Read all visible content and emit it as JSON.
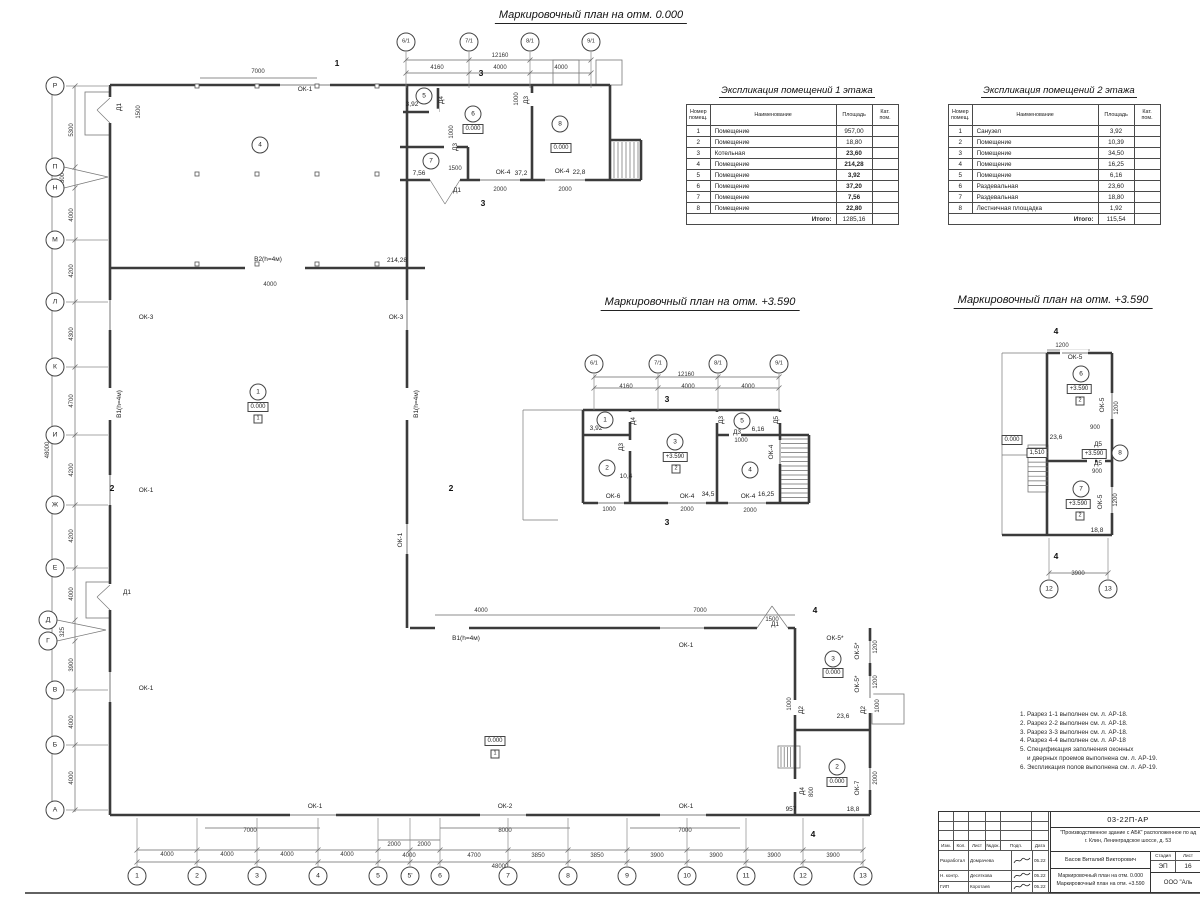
{
  "plans": {
    "main": {
      "title": "Маркировочный план на отм. 0.000",
      "x": 591,
      "y": 17
    },
    "mezz": {
      "title": "Маркировочный план на отм. +3.590",
      "x": 700,
      "y": 304
    },
    "right": {
      "title": "Маркировочный план на отм. +3.590",
      "x": 1053,
      "y": 302
    }
  },
  "tables": {
    "floor1": {
      "title": "Экспликация помещений 1 этажа",
      "headers": [
        "Номер помещ.",
        "Наименование",
        "Площадь",
        "Кат. пом."
      ],
      "rows": [
        [
          "1",
          "Помещение",
          "957,00"
        ],
        [
          "2",
          "Помещение",
          "18,80"
        ],
        [
          "3",
          "Котельная",
          "23,60"
        ],
        [
          "4",
          "Помещение",
          "214,28"
        ],
        [
          "5",
          "Помещение",
          "3,92"
        ],
        [
          "6",
          "Помещение",
          "37,20"
        ],
        [
          "7",
          "Помещение",
          "7,56"
        ],
        [
          "8",
          "Помещение",
          "22,80"
        ]
      ],
      "total_label": "Итого:",
      "total": "1285,16"
    },
    "floor2": {
      "title": "Экспликация помещений 2 этажа",
      "headers": [
        "Номер помещ.",
        "Наименование",
        "Площадь",
        "Кат. пом."
      ],
      "rows": [
        [
          "1",
          "Санузел",
          "3,92"
        ],
        [
          "2",
          "Помещение",
          "10,39"
        ],
        [
          "3",
          "Помещение",
          "34,50"
        ],
        [
          "4",
          "Помещение",
          "16,25"
        ],
        [
          "5",
          "Помещение",
          "6,16"
        ],
        [
          "6",
          "Раздевальная",
          "23,60"
        ],
        [
          "7",
          "Раздевальная",
          "18,80"
        ],
        [
          "8",
          "Лестничная площадка",
          "1,92"
        ]
      ],
      "total_label": "Итого:",
      "total": "115,54"
    }
  },
  "notes": [
    "1. Разрез 1-1 выполнен см. л. АР-18.",
    "2. Разрез 2-2 выполнен см. л. АР-18.",
    "3. Разрез 3-3 выполнен см. л. АР-18.",
    "4. Разрез 4-4 выполнен см. л. АР-18",
    "5. Спецификация заполнения оконных\n    и дверных проемов выполнена см. л. АР-19.",
    "6. Экспликация полов выполнена см. л. АР-19."
  ],
  "title_block": {
    "doc_code": "03-22П-АР",
    "project_line1": "\"Производственное здание с АБК\" расположенное по ад",
    "project_line2": "г. Клин, Ленинградское шоссе, д. 53",
    "columns": [
      "Изм.",
      "Кол.",
      "Лист",
      "№док.",
      "Подп.",
      "Дата"
    ],
    "rows": [
      {
        "role": "Разработал",
        "name": "Домрачева",
        "date": "05.22"
      },
      {
        "role": "Н. контр.",
        "name": "Десяткова",
        "date": "05.22"
      },
      {
        "role": "ГИП",
        "name": "Коротаев",
        "date": "05.22"
      }
    ],
    "author": "Басов Виталий Викторович",
    "stage_label": "Стадия",
    "sheet_label": "Лист",
    "stage": "ЭП",
    "sheet_no": "16",
    "doc_title1": "Маркировочный план на отм. 0.000",
    "doc_title2": "Маркировочный план на отм. +3.590",
    "company": "ООО \"Аль"
  },
  "axes": {
    "left": [
      [
        "Р",
        55,
        86
      ],
      [
        "П",
        55,
        167
      ],
      [
        "Н",
        55,
        188
      ],
      [
        "М",
        55,
        240
      ],
      [
        "Л",
        55,
        302
      ],
      [
        "К",
        55,
        367
      ],
      [
        "И",
        55,
        435
      ],
      [
        "Ж",
        55,
        505
      ],
      [
        "Е",
        55,
        568
      ],
      [
        "Д",
        48,
        620
      ],
      [
        "Г",
        48,
        641
      ],
      [
        "В",
        55,
        690
      ],
      [
        "Б",
        55,
        745
      ],
      [
        "А",
        55,
        810
      ]
    ],
    "bottom": [
      [
        "1",
        137,
        876
      ],
      [
        "2",
        197,
        876
      ],
      [
        "3",
        257,
        876
      ],
      [
        "4",
        318,
        876
      ],
      [
        "5",
        378,
        876
      ],
      [
        "5'",
        410,
        876
      ],
      [
        "6",
        440,
        876
      ],
      [
        "7",
        508,
        876
      ],
      [
        "8",
        568,
        876
      ],
      [
        "9",
        627,
        876
      ],
      [
        "10",
        687,
        876
      ],
      [
        "11",
        746,
        876
      ],
      [
        "12",
        803,
        876
      ],
      [
        "13",
        863,
        876
      ]
    ],
    "top_main": [
      [
        "6/1",
        406,
        42
      ],
      [
        "7/1",
        469,
        42
      ],
      [
        "8/1",
        530,
        42
      ],
      [
        "9/1",
        591,
        42
      ]
    ],
    "mezz": [
      [
        "6/1",
        594,
        364
      ],
      [
        "7/1",
        658,
        364
      ],
      [
        "8/1",
        718,
        364
      ],
      [
        "9/1",
        779,
        364
      ]
    ],
    "right_bottom": [
      [
        "12",
        1049,
        589
      ],
      [
        "13",
        1108,
        589
      ]
    ]
  },
  "rooms": {
    "main": [
      [
        "4",
        260,
        145
      ],
      [
        "5",
        424,
        96
      ],
      [
        "6",
        473,
        114
      ],
      [
        "7",
        431,
        161
      ],
      [
        "8",
        560,
        124
      ],
      [
        "1",
        258,
        392
      ],
      [
        "3",
        833,
        659
      ],
      [
        "2",
        837,
        767
      ]
    ],
    "mezz": [
      [
        "1",
        605,
        420
      ],
      [
        "2",
        607,
        468
      ],
      [
        "3",
        675,
        442
      ],
      [
        "5",
        742,
        421
      ],
      [
        "4",
        750,
        470
      ]
    ],
    "right": [
      [
        "6",
        1081,
        374
      ],
      [
        "7",
        1081,
        489
      ],
      [
        "8",
        1120,
        453
      ]
    ]
  },
  "labels": [
    [
      "ОК-1",
      305,
      90,
      "l"
    ],
    [
      "3,92",
      412,
      105,
      "l"
    ],
    [
      "7,56",
      419,
      174,
      "l"
    ],
    [
      "ОК-4",
      503,
      173,
      "l"
    ],
    [
      "37,2",
      521,
      174,
      "l"
    ],
    [
      "ОК-4",
      562,
      172,
      "l"
    ],
    [
      "22,8",
      579,
      173,
      "l"
    ],
    [
      "Д1",
      457,
      191,
      "l"
    ],
    [
      "В2(h=4м)",
      268,
      260,
      "l"
    ],
    [
      "214,28",
      397,
      261,
      "l"
    ],
    [
      "ОК-3",
      146,
      318,
      "l"
    ],
    [
      "ОК-3",
      396,
      318,
      "l"
    ],
    [
      "ОК-1",
      146,
      491,
      "l"
    ],
    [
      "ОК-1",
      146,
      689,
      "l"
    ],
    [
      "Д1",
      127,
      593,
      "l"
    ],
    [
      "В1(h=4м)",
      466,
      639,
      "l"
    ],
    [
      "ОК-1",
      686,
      646,
      "l"
    ],
    [
      "Д1",
      775,
      625,
      "l"
    ],
    [
      "ОК-5*",
      835,
      639,
      "l"
    ],
    [
      "23,6",
      843,
      717,
      "l"
    ],
    [
      "957",
      791,
      810,
      "l"
    ],
    [
      "18,8",
      853,
      810,
      "l"
    ],
    [
      "ОК-1",
      315,
      807,
      "l"
    ],
    [
      "ОК-2",
      505,
      807,
      "l"
    ],
    [
      "ОК-1",
      686,
      807,
      "l"
    ],
    [
      "Д1",
      120,
      107,
      "lr"
    ],
    [
      "Д4",
      442,
      100,
      "lr"
    ],
    [
      "Д3",
      527,
      100,
      "lr"
    ],
    [
      "Д3",
      456,
      147,
      "lr"
    ],
    [
      "В1(h=4м)",
      120,
      404,
      "lr"
    ],
    [
      "В1(h=4м)",
      417,
      404,
      "lr"
    ],
    [
      "ОК-1",
      401,
      540,
      "lr"
    ],
    [
      "ОК-5*",
      858,
      651,
      "lr"
    ],
    [
      "ОК-5*",
      858,
      684,
      "lr"
    ],
    [
      "Д2",
      802,
      710,
      "lr"
    ],
    [
      "Д2",
      864,
      710,
      "lr"
    ],
    [
      "ОК-7",
      858,
      788,
      "lr"
    ],
    [
      "Д4",
      803,
      791,
      "lr"
    ],
    [
      "7000",
      258,
      72,
      "d"
    ],
    [
      "12160",
      500,
      56,
      "d"
    ],
    [
      "4160",
      437,
      68,
      "d"
    ],
    [
      "4000",
      500,
      68,
      "d"
    ],
    [
      "4000",
      561,
      68,
      "d"
    ],
    [
      "1000",
      452,
      132,
      "dr"
    ],
    [
      "1500",
      455,
      169,
      "d"
    ],
    [
      "2000",
      500,
      190,
      "d"
    ],
    [
      "2000",
      565,
      190,
      "d"
    ],
    [
      "1000",
      517,
      99,
      "dr"
    ],
    [
      "1500",
      139,
      112,
      "dr"
    ],
    [
      "4000",
      270,
      285,
      "d"
    ],
    [
      "4000",
      481,
      611,
      "d"
    ],
    [
      "7000",
      700,
      611,
      "d"
    ],
    [
      "1500",
      772,
      620,
      "d"
    ],
    [
      "5300",
      72,
      130,
      "dr"
    ],
    [
      "300",
      63,
      178,
      "dr"
    ],
    [
      "4000",
      72,
      215,
      "dr"
    ],
    [
      "4200",
      72,
      271,
      "dr"
    ],
    [
      "4300",
      72,
      334,
      "dr"
    ],
    [
      "4700",
      72,
      401,
      "dr"
    ],
    [
      "4200",
      72,
      470,
      "dr"
    ],
    [
      "4200",
      72,
      536,
      "dr"
    ],
    [
      "4000",
      72,
      594,
      "dr"
    ],
    [
      "325",
      63,
      632,
      "dr"
    ],
    [
      "3900",
      72,
      665,
      "dr"
    ],
    [
      "4000",
      72,
      722,
      "dr"
    ],
    [
      "4000",
      72,
      778,
      "dr"
    ],
    [
      "48000",
      48,
      450,
      "dr"
    ],
    [
      "1200",
      876,
      647,
      "dr"
    ],
    [
      "1200",
      876,
      682,
      "dr"
    ],
    [
      "1000",
      790,
      704,
      "dr"
    ],
    [
      "1000",
      878,
      706,
      "dr"
    ],
    [
      "2000",
      876,
      778,
      "dr"
    ],
    [
      "800",
      812,
      792,
      "dr"
    ],
    [
      "7000",
      250,
      831,
      "d"
    ],
    [
      "8000",
      505,
      831,
      "d"
    ],
    [
      "7000",
      685,
      831,
      "d"
    ],
    [
      "4000",
      167,
      855,
      "d"
    ],
    [
      "4000",
      227,
      855,
      "d"
    ],
    [
      "4000",
      287,
      855,
      "d"
    ],
    [
      "4000",
      347,
      855,
      "d"
    ],
    [
      "2000",
      394,
      845,
      "d"
    ],
    [
      "2000",
      424,
      845,
      "d"
    ],
    [
      "4000",
      409,
      856,
      "d"
    ],
    [
      "4700",
      474,
      856,
      "d"
    ],
    [
      "3850",
      538,
      856,
      "d"
    ],
    [
      "3850",
      597,
      856,
      "d"
    ],
    [
      "3900",
      657,
      856,
      "d"
    ],
    [
      "3900",
      716,
      856,
      "d"
    ],
    [
      "3900",
      774,
      856,
      "d"
    ],
    [
      "3900",
      833,
      856,
      "d"
    ],
    [
      "48000",
      500,
      867,
      "d"
    ],
    [
      "0.000",
      473,
      129,
      "b"
    ],
    [
      "0.000",
      561,
      148,
      "b"
    ],
    [
      "0.000",
      258,
      407,
      "b"
    ],
    [
      "0.000",
      495,
      741,
      "b"
    ],
    [
      "0.000",
      833,
      673,
      "b"
    ],
    [
      "0.000",
      837,
      782,
      "b"
    ],
    [
      "0.000",
      1012,
      440,
      "b"
    ],
    [
      "+3.590",
      675,
      457,
      "b"
    ],
    [
      "+3.590",
      1079,
      389,
      "b"
    ],
    [
      "+3.590",
      1094,
      454,
      "b"
    ],
    [
      "+3.590",
      1078,
      504,
      "b"
    ],
    [
      "1,510",
      1037,
      453,
      "b"
    ],
    [
      "1",
      258,
      419,
      "s"
    ],
    [
      "1",
      495,
      754,
      "s"
    ],
    [
      "2",
      676,
      469,
      "s"
    ],
    [
      "2",
      1080,
      401,
      "s"
    ],
    [
      "2",
      1080,
      516,
      "s"
    ],
    [
      "1",
      337,
      63,
      "sec"
    ],
    [
      "1",
      320,
      878,
      "sec"
    ],
    [
      "2",
      451,
      488,
      "sec"
    ],
    [
      "2",
      112,
      488,
      "sec"
    ],
    [
      "3",
      481,
      73,
      "sec"
    ],
    [
      "3",
      483,
      203,
      "sec"
    ],
    [
      "3",
      667,
      399,
      "sec"
    ],
    [
      "3",
      667,
      522,
      "sec"
    ],
    [
      "4",
      815,
      610,
      "sec"
    ],
    [
      "4",
      813,
      834,
      "sec"
    ],
    [
      "4",
      1056,
      331,
      "sec"
    ],
    [
      "4",
      1056,
      556,
      "sec"
    ],
    [
      "3,92",
      596,
      429,
      "l"
    ],
    [
      "10,4",
      626,
      477,
      "l"
    ],
    [
      "34,5",
      708,
      495,
      "l"
    ],
    [
      "16,25",
      766,
      495,
      "l"
    ],
    [
      "6,16",
      758,
      430,
      "l"
    ],
    [
      "ОК-6",
      613,
      497,
      "l"
    ],
    [
      "ОК-4",
      687,
      497,
      "l"
    ],
    [
      "ОК-4",
      748,
      497,
      "l"
    ],
    [
      "Д3",
      737,
      433,
      "l"
    ],
    [
      "Д4",
      634,
      421,
      "lr"
    ],
    [
      "Д3",
      622,
      447,
      "lr"
    ],
    [
      "Д3",
      722,
      420,
      "lr"
    ],
    [
      "Д5",
      777,
      420,
      "lr"
    ],
    [
      "ОК-4",
      772,
      452,
      "lr"
    ],
    [
      "12160",
      686,
      375,
      "d"
    ],
    [
      "4160",
      626,
      387,
      "d"
    ],
    [
      "4000",
      688,
      387,
      "d"
    ],
    [
      "4000",
      748,
      387,
      "d"
    ],
    [
      "1000",
      609,
      510,
      "d"
    ],
    [
      "2000",
      687,
      510,
      "d"
    ],
    [
      "2000",
      750,
      511,
      "d"
    ],
    [
      "1000",
      741,
      441,
      "d"
    ],
    [
      "ОК-5",
      1075,
      358,
      "l"
    ],
    [
      "Д5",
      1098,
      445,
      "l"
    ],
    [
      "Д5",
      1098,
      464,
      "l"
    ],
    [
      "23,6",
      1056,
      438,
      "l"
    ],
    [
      "18,8",
      1097,
      531,
      "l"
    ],
    [
      "ОК-5",
      1103,
      405,
      "lr"
    ],
    [
      "ОК-5",
      1101,
      502,
      "lr"
    ],
    [
      "1200",
      1062,
      346,
      "d"
    ],
    [
      "3900",
      1078,
      574,
      "d"
    ],
    [
      "900",
      1095,
      428,
      "d"
    ],
    [
      "900",
      1097,
      472,
      "d"
    ],
    [
      "1200",
      1117,
      408,
      "dr"
    ],
    [
      "1200",
      1116,
      500,
      "dr"
    ]
  ]
}
